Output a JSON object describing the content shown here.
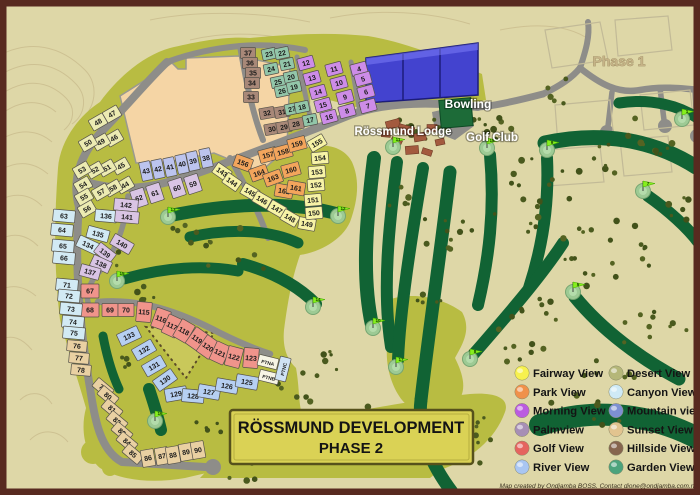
{
  "title": {
    "line1": "RÖSSMUND DEVELOPMENT",
    "line2": "PHASE 2"
  },
  "labels": {
    "bowling": "Bowling",
    "lodge": "Rössmund Lodge",
    "golf_club": "Golf Club",
    "phase1": "Phase 1"
  },
  "footer": "Map created by Ondjamba BOSS.  Contact dione@ondjamba.com.na",
  "legend": {
    "items": [
      {
        "label": "Fairway View",
        "color": "#f7f14e"
      },
      {
        "label": "Park View",
        "color": "#f0914a"
      },
      {
        "label": "Morning View",
        "color": "#bb5ce0"
      },
      {
        "label": "Palmview",
        "color": "#a78fb5"
      },
      {
        "label": "Golf View",
        "color": "#e5645f"
      },
      {
        "label": "River View",
        "color": "#a9c6f2"
      },
      {
        "label": "Desert View",
        "color": "#b5b779"
      },
      {
        "label": "Canyon View",
        "color": "#cfeaf6"
      },
      {
        "label": "Mountain view",
        "color": "#7e90d2"
      },
      {
        "label": "Sunset View",
        "color": "#e2c48f"
      },
      {
        "label": "Hillside View",
        "color": "#86654e"
      },
      {
        "label": "Garden View",
        "color": "#4ba37c"
      }
    ]
  },
  "colors": {
    "terrain": "#ded7a7",
    "olive": "#b8bc42",
    "dune": "#c9c85a",
    "peach": "#f5d5a5",
    "road": "#8e8d89",
    "fairway": "#116334",
    "green_circle": "#9dca94",
    "flag": "#86ef1e",
    "tree": "#4a5a1e",
    "contour": "#ccbf90",
    "border": "#582a20",
    "title_box": "#dad255",
    "special_blue": "#4343cf",
    "phase1_block": "#c2ba97",
    "lodge_building": "#a35a3e"
  },
  "plot_groups": [
    {
      "view": "Desert View",
      "fill": "#ecebb2",
      "w": 16,
      "h": 12,
      "cells": [
        [
          "47",
          112,
          114,
          -30
        ],
        [
          "48",
          98,
          122,
          -30
        ],
        [
          "46",
          114,
          138,
          -30
        ],
        [
          "49",
          101,
          142,
          -30
        ],
        [
          "50",
          88,
          143,
          -30
        ],
        [
          "45",
          121,
          166,
          -30
        ],
        [
          "51",
          107,
          168,
          -30
        ],
        [
          "52",
          95,
          170,
          -30
        ],
        [
          "53",
          82,
          170,
          -30
        ],
        [
          "44",
          125,
          185,
          -30
        ],
        [
          "58",
          113,
          188,
          -30
        ],
        [
          "57",
          101,
          192,
          -30
        ],
        [
          "54",
          83,
          185,
          -30
        ],
        [
          "55",
          84,
          197,
          -30
        ],
        [
          "56",
          87,
          209,
          -30
        ]
      ]
    },
    {
      "view": "Mountain view",
      "fill": "#bcc4ee",
      "w": 11,
      "h": 19,
      "cells": [
        [
          "43",
          146,
          171,
          -12
        ],
        [
          "42",
          158,
          169,
          -12
        ],
        [
          "41",
          170,
          167,
          -12
        ],
        [
          "40",
          182,
          164,
          -12
        ],
        [
          "39",
          193,
          161,
          -12
        ],
        [
          "38",
          206,
          158,
          -12
        ]
      ]
    },
    {
      "view": "Morning View",
      "fill": "#cd8ce8",
      "w": 16,
      "h": 12,
      "cells": [
        [
          "12",
          306,
          63,
          -15
        ],
        [
          "13",
          312,
          78,
          -15
        ],
        [
          "14",
          318,
          92,
          -15
        ],
        [
          "15",
          323,
          105,
          -15
        ],
        [
          "16",
          329,
          117,
          -15
        ],
        [
          "11",
          334,
          69,
          -15
        ],
        [
          "10",
          339,
          83,
          -15
        ],
        [
          "9",
          345,
          97,
          -15
        ],
        [
          "8",
          347,
          111,
          -15
        ],
        [
          "4",
          359,
          69,
          -15
        ],
        [
          "5",
          363,
          79,
          -15
        ],
        [
          "6",
          366,
          92,
          -15
        ],
        [
          "7",
          368,
          106,
          -15
        ]
      ]
    },
    {
      "view": "Hillside View",
      "fill": "#a88878",
      "w": 15,
      "h": 11,
      "cells": [
        [
          "37",
          248,
          53,
          0
        ],
        [
          "36",
          250,
          63,
          0
        ],
        [
          "35",
          253,
          73,
          0
        ],
        [
          "34",
          252,
          83,
          0
        ],
        [
          "33",
          251,
          97,
          0
        ],
        [
          "32",
          267,
          113,
          -10
        ],
        [
          "31",
          282,
          112,
          -10
        ],
        [
          "30",
          272,
          129,
          -10
        ],
        [
          "29",
          284,
          127,
          -10
        ],
        [
          "28",
          296,
          124,
          -10
        ]
      ]
    },
    {
      "view": "Garden View",
      "fill": "#92c6a9",
      "w": 14,
      "h": 11,
      "cells": [
        [
          "23",
          269,
          54,
          -12
        ],
        [
          "22",
          282,
          53,
          -12
        ],
        [
          "24",
          271,
          69,
          -12
        ],
        [
          "21",
          287,
          64,
          -12
        ],
        [
          "25",
          278,
          82,
          -12
        ],
        [
          "20",
          291,
          77,
          -12
        ],
        [
          "26",
          282,
          91,
          -12
        ],
        [
          "19",
          294,
          87,
          -12
        ],
        [
          "27",
          292,
          109,
          -12
        ],
        [
          "18",
          302,
          107,
          -12
        ],
        [
          "17",
          310,
          120,
          -12
        ]
      ]
    },
    {
      "view": "Park View",
      "fill": "#f3a55c",
      "w": 18,
      "h": 13,
      "cells": [
        [
          "156",
          243,
          163,
          20
        ],
        [
          "157",
          268,
          155,
          -15
        ],
        [
          "158",
          283,
          152,
          -15
        ],
        [
          "159",
          297,
          144,
          -15
        ],
        [
          "164",
          259,
          173,
          -20
        ],
        [
          "163",
          273,
          178,
          -20
        ],
        [
          "160",
          291,
          170,
          -15
        ],
        [
          "162",
          284,
          191,
          10
        ],
        [
          "161",
          296,
          188,
          10
        ]
      ]
    },
    {
      "view": "Fairway View",
      "fill": "#f7f3a6",
      "w": 17,
      "h": 12,
      "cells": [
        [
          "143",
          222,
          172,
          35
        ],
        [
          "144",
          232,
          182,
          35
        ],
        [
          "145",
          250,
          192,
          30
        ],
        [
          "146",
          262,
          200,
          30
        ],
        [
          "147",
          277,
          209,
          30
        ],
        [
          "148",
          290,
          218,
          30
        ],
        [
          "149",
          307,
          224,
          10
        ],
        [
          "150",
          314,
          213,
          -5
        ],
        [
          "151",
          313,
          200,
          -5
        ],
        [
          "152",
          316,
          185,
          -5
        ],
        [
          "153",
          317,
          172,
          -5
        ],
        [
          "154",
          320,
          158,
          -5
        ],
        [
          "155",
          317,
          143,
          -30
        ]
      ]
    },
    {
      "view": "Golf View",
      "fill": "#f0948b",
      "w": 16,
      "h": 13,
      "cells": [
        [
          "67",
          90,
          291,
          0,
          18,
          14
        ],
        [
          "68",
          90,
          310,
          0,
          18,
          14
        ],
        [
          "69",
          110,
          310,
          0
        ],
        [
          "70",
          126,
          310,
          0
        ],
        [
          "115",
          144,
          312,
          5,
          15,
          20
        ],
        [
          "116",
          161,
          319,
          20,
          15,
          20
        ],
        [
          "117",
          172,
          326,
          25,
          15,
          20
        ],
        [
          "118",
          184,
          331,
          30,
          15,
          20
        ],
        [
          "119",
          197,
          339,
          35,
          15,
          20
        ],
        [
          "120",
          208,
          347,
          35,
          15,
          20
        ],
        [
          "121",
          220,
          353,
          25,
          15,
          20
        ],
        [
          "122",
          234,
          357,
          15,
          15,
          20
        ],
        [
          "123",
          251,
          358,
          5,
          15,
          20
        ]
      ]
    },
    {
      "view": "River View",
      "fill": "#b6cff2",
      "w": 22,
      "h": 13,
      "cells": [
        [
          "133",
          129,
          336,
          -25
        ],
        [
          "132",
          144,
          350,
          -30
        ],
        [
          "131",
          154,
          366,
          -30
        ],
        [
          "130",
          165,
          380,
          -35
        ],
        [
          "129",
          176,
          394,
          -10
        ],
        [
          "128",
          193,
          396,
          5
        ],
        [
          "127",
          209,
          392,
          10
        ],
        [
          "126",
          227,
          386,
          10
        ],
        [
          "125",
          247,
          382,
          10
        ]
      ]
    },
    {
      "view": "Canyon View",
      "fill": "#d2eaf4",
      "w": 22,
      "h": 12,
      "cells": [
        [
          "63",
          64,
          216,
          5
        ],
        [
          "64",
          62,
          230,
          5
        ],
        [
          "65",
          63,
          246,
          5
        ],
        [
          "66",
          64,
          258,
          5
        ],
        [
          "71",
          67,
          285,
          5
        ],
        [
          "72",
          69,
          296,
          5
        ],
        [
          "73",
          71,
          309,
          5
        ],
        [
          "74",
          73,
          322,
          5
        ],
        [
          "75",
          74,
          333,
          5
        ],
        [
          "134",
          88,
          245,
          25
        ],
        [
          "135",
          98,
          234,
          15
        ],
        [
          "136",
          106,
          216,
          5
        ]
      ]
    },
    {
      "view": "Sunset View",
      "fill": "#e9d0a2",
      "w": 20,
      "h": 11,
      "cells": [
        [
          "76",
          77,
          346,
          5
        ],
        [
          "77",
          79,
          358,
          5
        ],
        [
          "78",
          81,
          370,
          5
        ],
        [
          "79",
          103,
          388,
          40
        ],
        [
          "80",
          108,
          396,
          40
        ],
        [
          "81",
          112,
          409,
          40
        ],
        [
          "82",
          117,
          421,
          40
        ],
        [
          "83",
          122,
          432,
          40
        ],
        [
          "84",
          127,
          442,
          40
        ],
        [
          "85",
          133,
          454,
          40
        ],
        [
          "86",
          148,
          458,
          -10,
          13,
          17
        ],
        [
          "87",
          162,
          456,
          -10,
          13,
          17
        ],
        [
          "88",
          173,
          455,
          -10,
          13,
          17
        ],
        [
          "89",
          186,
          452,
          -10,
          13,
          17
        ],
        [
          "90",
          198,
          450,
          -10,
          13,
          17
        ]
      ]
    },
    {
      "view": "Palmview",
      "fill": "#d9c4e4",
      "w": 14,
      "h": 18,
      "cells": [
        [
          "59",
          193,
          184,
          -18
        ],
        [
          "60",
          177,
          188,
          -18
        ],
        [
          "61",
          155,
          193,
          -18
        ],
        [
          "62",
          139,
          198,
          -18
        ],
        [
          "142",
          126,
          205,
          5,
          24,
          12
        ],
        [
          "141",
          127,
          217,
          5,
          24,
          12
        ],
        [
          "140",
          122,
          244,
          30,
          22,
          12
        ],
        [
          "139",
          105,
          253,
          38,
          20,
          12
        ],
        [
          "138",
          101,
          264,
          25,
          20,
          12
        ],
        [
          "137",
          90,
          272,
          15,
          20,
          12
        ]
      ]
    },
    {
      "view": "PTN",
      "fill": "#f7f4e4",
      "w": 20,
      "h": 11,
      "fs": 4.8,
      "cells": [
        [
          "PTNA",
          268,
          362,
          14
        ],
        [
          "PTNB",
          269,
          377,
          14
        ]
      ]
    },
    {
      "view": "PTN",
      "fill": "#cfe2f4",
      "w": 24,
      "h": 11,
      "fs": 4.8,
      "cells": [
        [
          "PTNC",
          283,
          369,
          -76
        ]
      ]
    }
  ],
  "golf_holes": [
    [
      "1",
      682,
      119
    ],
    [
      "5",
      573,
      292
    ],
    [
      "7",
      643,
      191
    ],
    [
      "8",
      470,
      359
    ],
    [
      "9",
      547,
      150
    ],
    [
      "10",
      373,
      328
    ],
    [
      "11",
      393,
      147
    ],
    [
      "12",
      338,
      216
    ],
    [
      "13",
      168,
      217
    ],
    [
      "14",
      313,
      307
    ],
    [
      "15",
      117,
      281
    ],
    [
      "16",
      155,
      421
    ],
    [
      "17",
      396,
      367
    ],
    [
      "18",
      487,
      148
    ]
  ]
}
